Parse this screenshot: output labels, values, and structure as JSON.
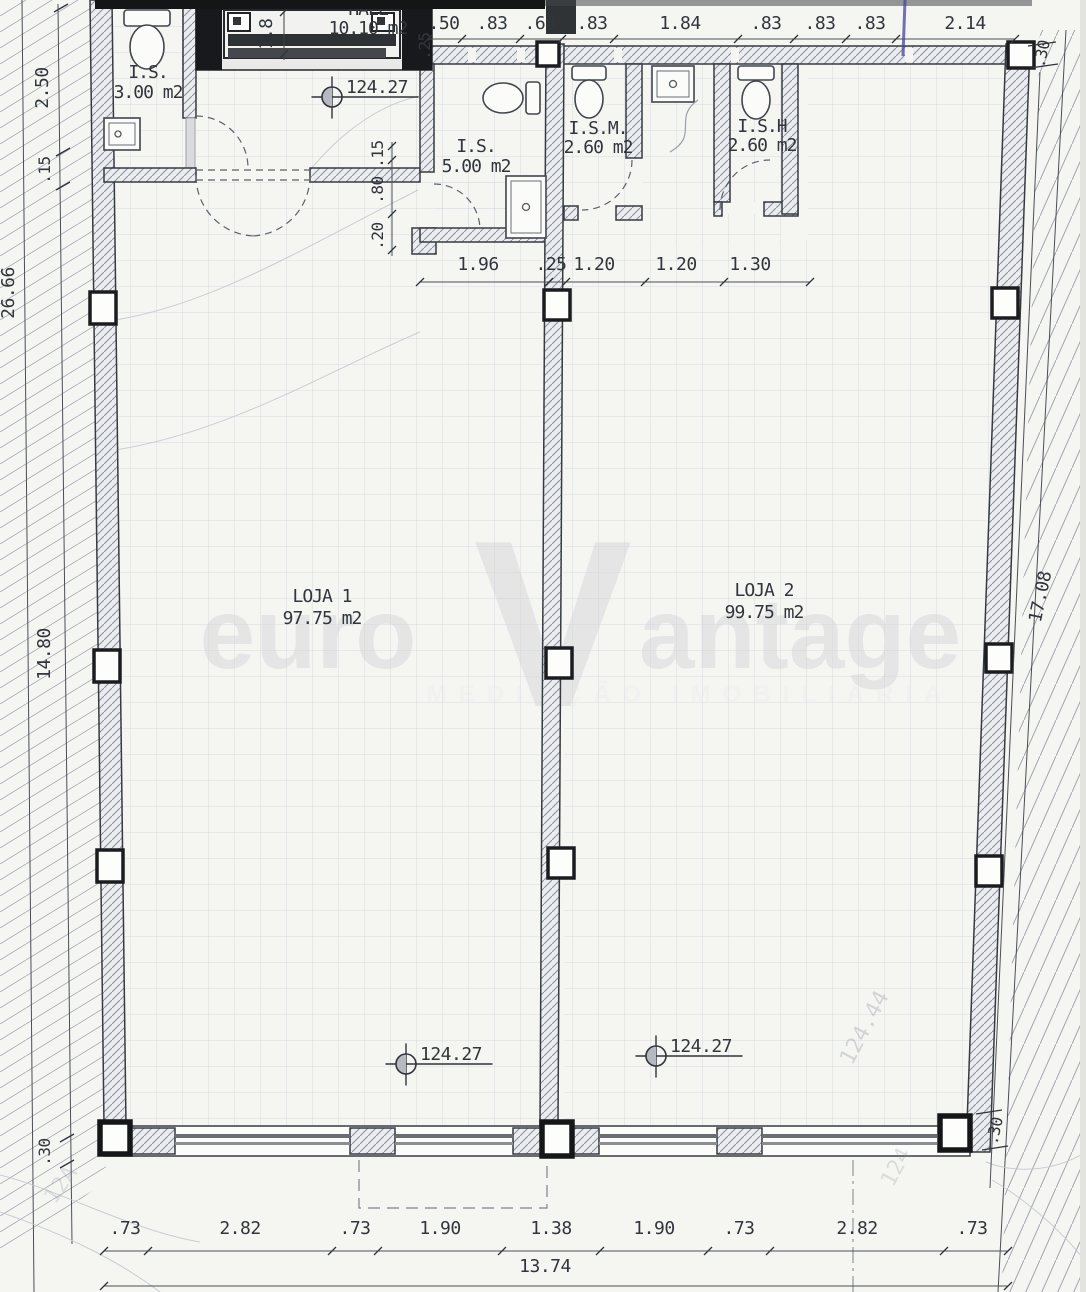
{
  "drawing": {
    "type": "architectural floor plan",
    "rooms": {
      "is_top_left": {
        "name": "I.S.",
        "area": "3.00 m2"
      },
      "hall": {
        "name": "HALL",
        "area": "10.10 m2"
      },
      "is_center": {
        "name": "I.S.",
        "area": "5.00 m2"
      },
      "ism": {
        "name": "I.S.M.",
        "area": "2.60 m2"
      },
      "ish": {
        "name": "I.S.H",
        "area": "2.60 m2"
      },
      "loja1": {
        "name": "LOJA 1",
        "area": "97.75 m2"
      },
      "loja2": {
        "name": "LOJA 2",
        "area": "99.75 m2"
      }
    },
    "level_value": "124.27",
    "dims": {
      "top": [
        ".50",
        ".83",
        ".68",
        ".83",
        "1.84",
        ".83",
        ".83",
        ".83",
        "2.14"
      ],
      "top_wall": ".25",
      "elevator": "1.8",
      "mid": [
        "1.96",
        ".25",
        "1.20",
        "1.20",
        "1.30"
      ],
      "door_stack": [
        ".15",
        ".80",
        ".20"
      ],
      "left": {
        "upper": "2.50",
        "upper_small": ".15",
        "total": "26.66",
        "loja": "14.80",
        "bottom": ".30"
      },
      "right": {
        "top": ".30",
        "total": "17.08",
        "bottom": ".30"
      },
      "bottom": [
        ".73",
        "2.82",
        ".73",
        "1.90",
        "1.38",
        "1.90",
        ".73",
        "2.82",
        ".73"
      ],
      "bottom_total": "13.74"
    },
    "ghost_marks": {
      "a": "124.44",
      "b": "124",
      "c": "12A"
    },
    "watermark": {
      "left": "euro",
      "vee": "V",
      "right": "antage",
      "subtext": "MEDIAÇÃO IMOBILIÁRIA"
    }
  }
}
